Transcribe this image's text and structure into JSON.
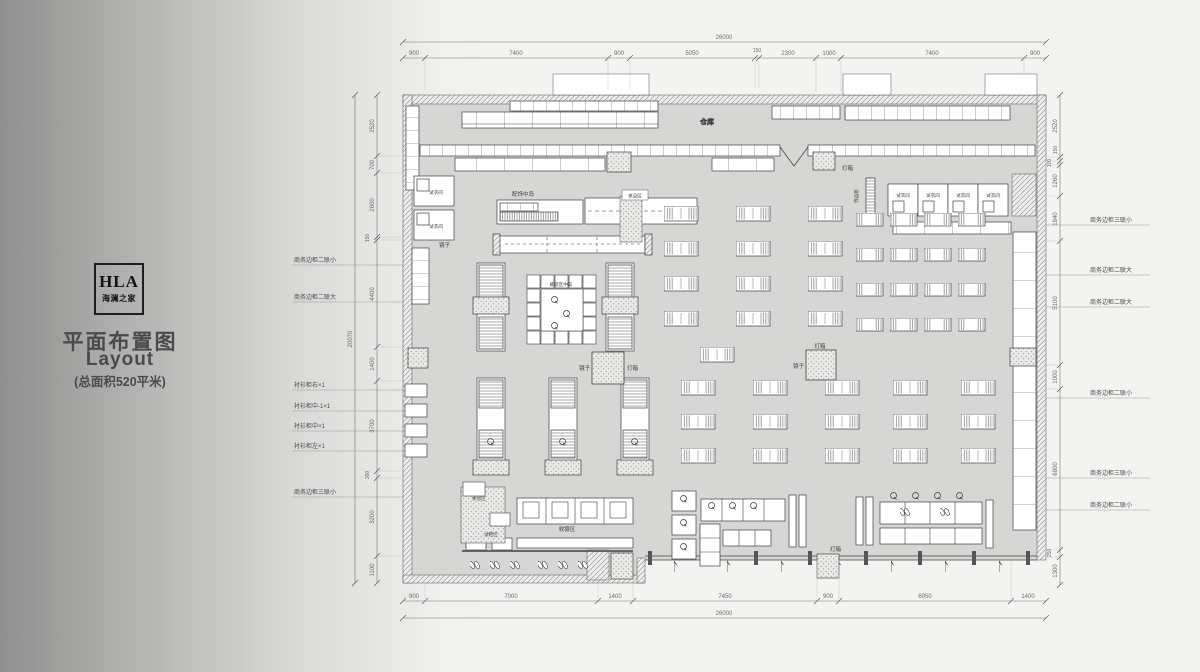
{
  "sidebar": {
    "logo_en": "HLA",
    "logo_cn": "海澜之家",
    "title_cn": "平面布置图",
    "title_en": "Layout",
    "subtitle": "(总面积520平米)"
  },
  "dimensions": {
    "top": {
      "overall": "26000",
      "segments": [
        "900",
        "7400",
        "900",
        "5050",
        "150",
        "2300",
        "1000",
        "7400",
        "900"
      ]
    },
    "bottom": {
      "overall": "26000",
      "segments": [
        "900",
        "7000",
        "1400",
        "7450",
        "900",
        "6950",
        "1400"
      ]
    },
    "left": {
      "overall": "20070",
      "segments": [
        "2520",
        "700",
        "2600",
        "150",
        "4400",
        "1400",
        "3700",
        "300",
        "3200",
        "1100"
      ]
    },
    "right": {
      "segments": [
        "2520",
        "150",
        "100",
        "1260",
        "1840",
        "5100",
        "1000",
        "6800",
        "250",
        "1300"
      ]
    }
  },
  "callouts": {
    "left": [
      "商务边柜二联小",
      "商务边柜二联大",
      "衬衫柜右×1",
      "衬衫柜中-1×1",
      "衬衫柜中×1",
      "衬衫柜左×1",
      "商务边柜三联小"
    ],
    "right": [
      "商务边柜三联小",
      "商务边柜二联大",
      "商务边柜二联大",
      "商务边柜二联小",
      "商务边柜三联小",
      "商务边柜二联小"
    ]
  },
  "rooms": {
    "warehouse": "仓库",
    "fitting_room": "试衣间",
    "mirror": "镜子",
    "lightbox": "灯箱",
    "accessories_island": "配饰中岛",
    "accessory_cabinet": "饰品柜",
    "center_island": "裤装区中岛",
    "cashier": "收银区",
    "rest_area": "休息区",
    "shoe_area": "试鞋区"
  }
}
